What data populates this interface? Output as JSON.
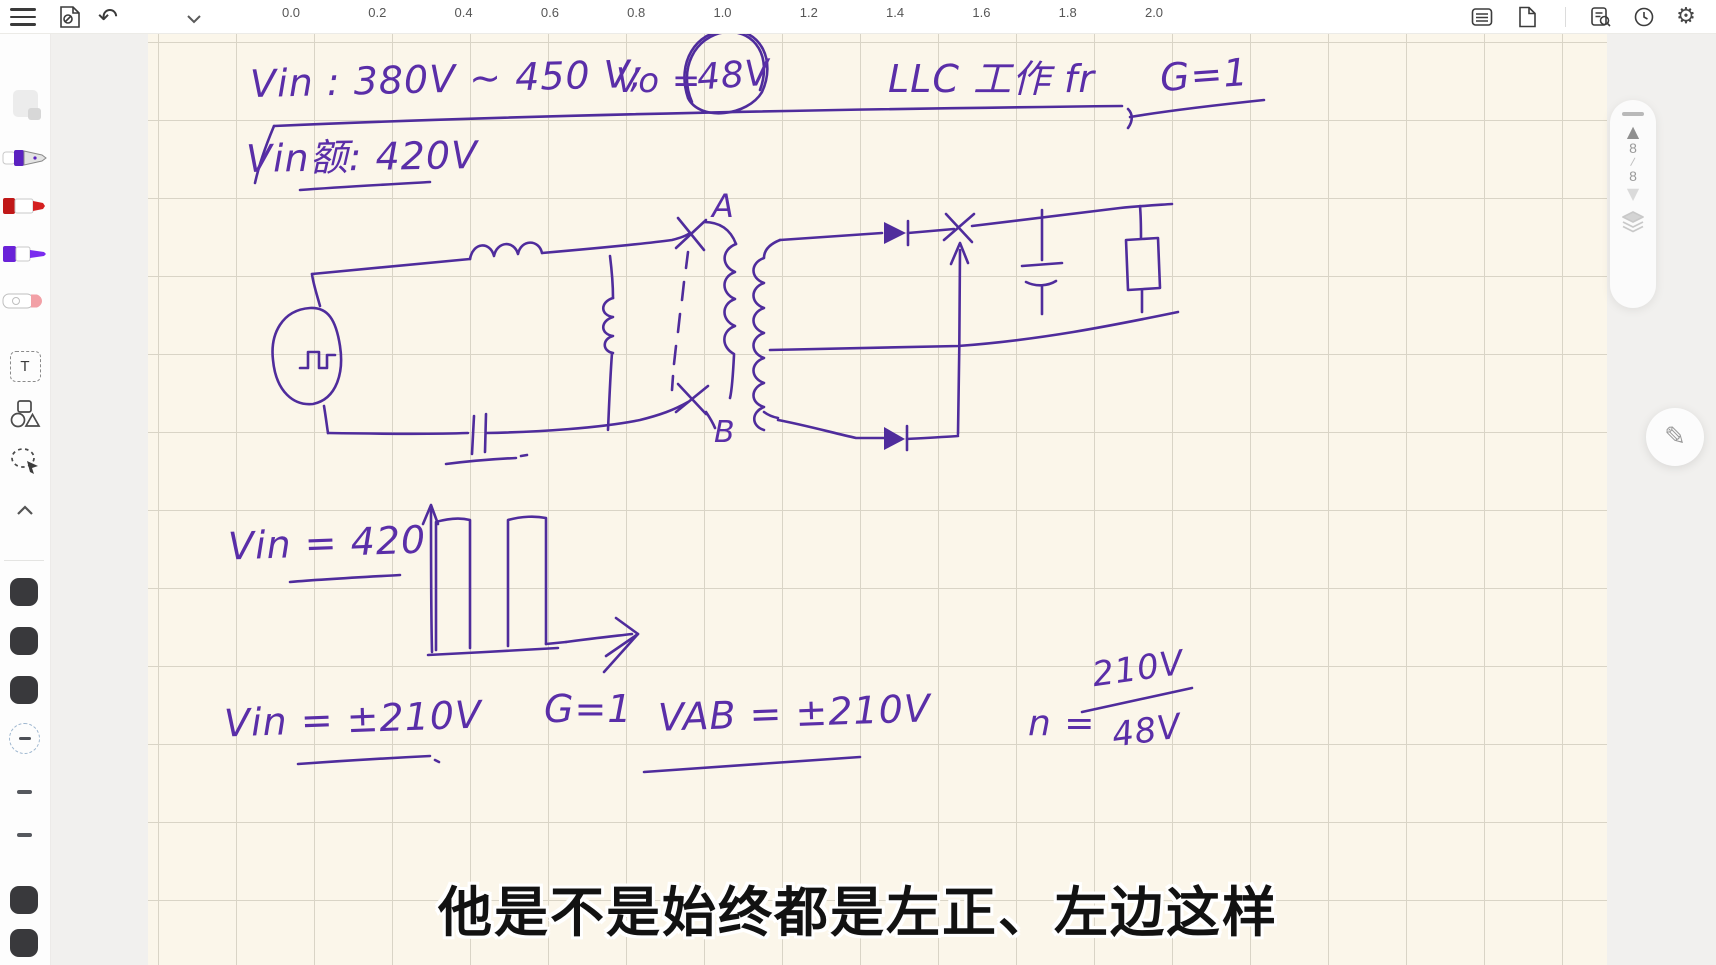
{
  "topbar": {
    "ruler_labels": [
      "0.0",
      "0.2",
      "0.4",
      "0.6",
      "0.8",
      "1.0",
      "1.2",
      "1.4",
      "1.6",
      "1.8",
      "2.0"
    ]
  },
  "icons": {
    "gear": "⚙",
    "undo": "↶",
    "pencil": "✎",
    "page_up": "▲",
    "page_down": "▼"
  },
  "pager": {
    "current": "8",
    "separator": "/",
    "total": "8"
  },
  "sidebar": {
    "text_tool_label": "T"
  },
  "ink": {
    "vin_range": "Vin : 380V ~ 450 V;",
    "vo_label": "Vo =",
    "vo_value": "48V",
    "llc_note": "LLC 工作 fr",
    "g_top": "G=1",
    "vin_rated": "Vin额: 420V",
    "node_a": "A",
    "node_b": "B",
    "vin_420": "Vin = 420",
    "vin_pm210": "Vin = ±210V",
    "g_bottom": "G=1",
    "vab_pm210": "VAB = ±210V",
    "n_label": "n =",
    "n_numerator": "210V",
    "n_denominator": "48V"
  },
  "subtitle": "他是不是始终都是左正、左边这样"
}
